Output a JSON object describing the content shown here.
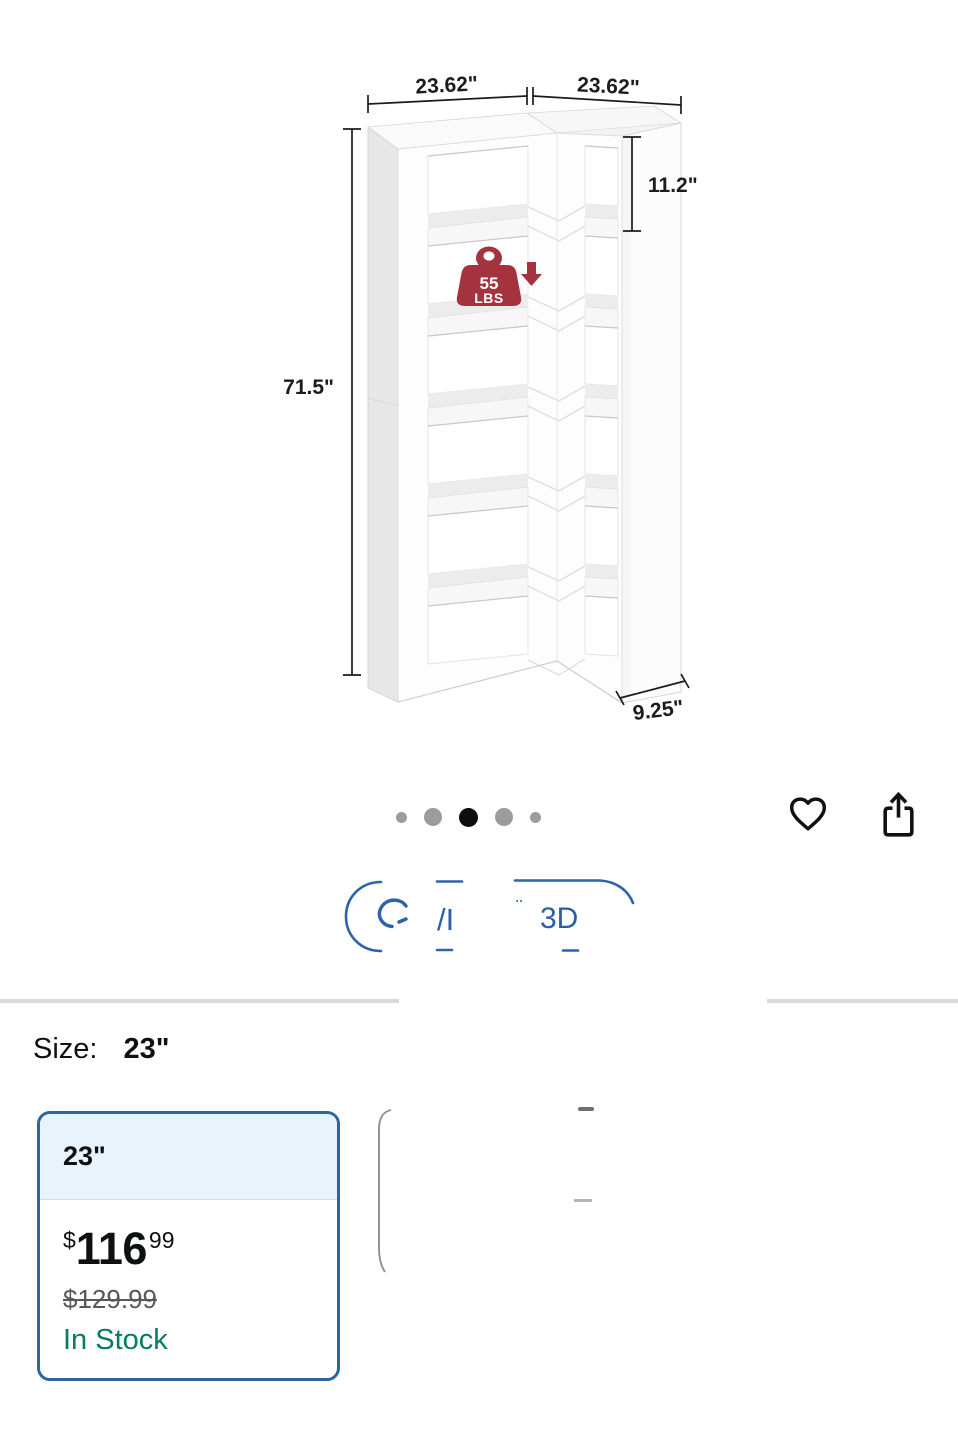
{
  "product_image": {
    "alt": "corner-bookshelf-dimension-diagram",
    "dimensions": {
      "width_left": "23.62\"",
      "width_right": "23.62\"",
      "shelf_spacing": "11.2\"",
      "height": "71.5\"",
      "depth": "9.25\""
    },
    "weight_badge": {
      "value": "55",
      "unit": "LBS",
      "color": "#A5333F"
    }
  },
  "carousel": {
    "total_dots": 5,
    "active_dot": 3
  },
  "action_bar": {
    "wishlist_icon": "heart-icon",
    "share_icon": "share-icon"
  },
  "view_3d_button": {
    "label": "View in 3D",
    "visible_fragments": {
      "frag1": "/I",
      "frag2": "¨",
      "frag3": "3D"
    },
    "accent": "#2B63AC"
  },
  "size_section": {
    "label": "Size:",
    "selected_value": "23\""
  },
  "size_option": {
    "name": "23\"",
    "price_symbol": "$",
    "price_whole": "116",
    "price_cents": "99",
    "list_price": "$129.99",
    "availability": "In Stock",
    "selected": true
  },
  "colors": {
    "selected_swatch_border": "#2B66A1",
    "swatch_header_bg": "#E9F3FB",
    "badge_red": "#A5333F",
    "in_stock_green": "#067D62",
    "list_price_gray": "#565959",
    "view3d_blue": "#2B63AC"
  }
}
